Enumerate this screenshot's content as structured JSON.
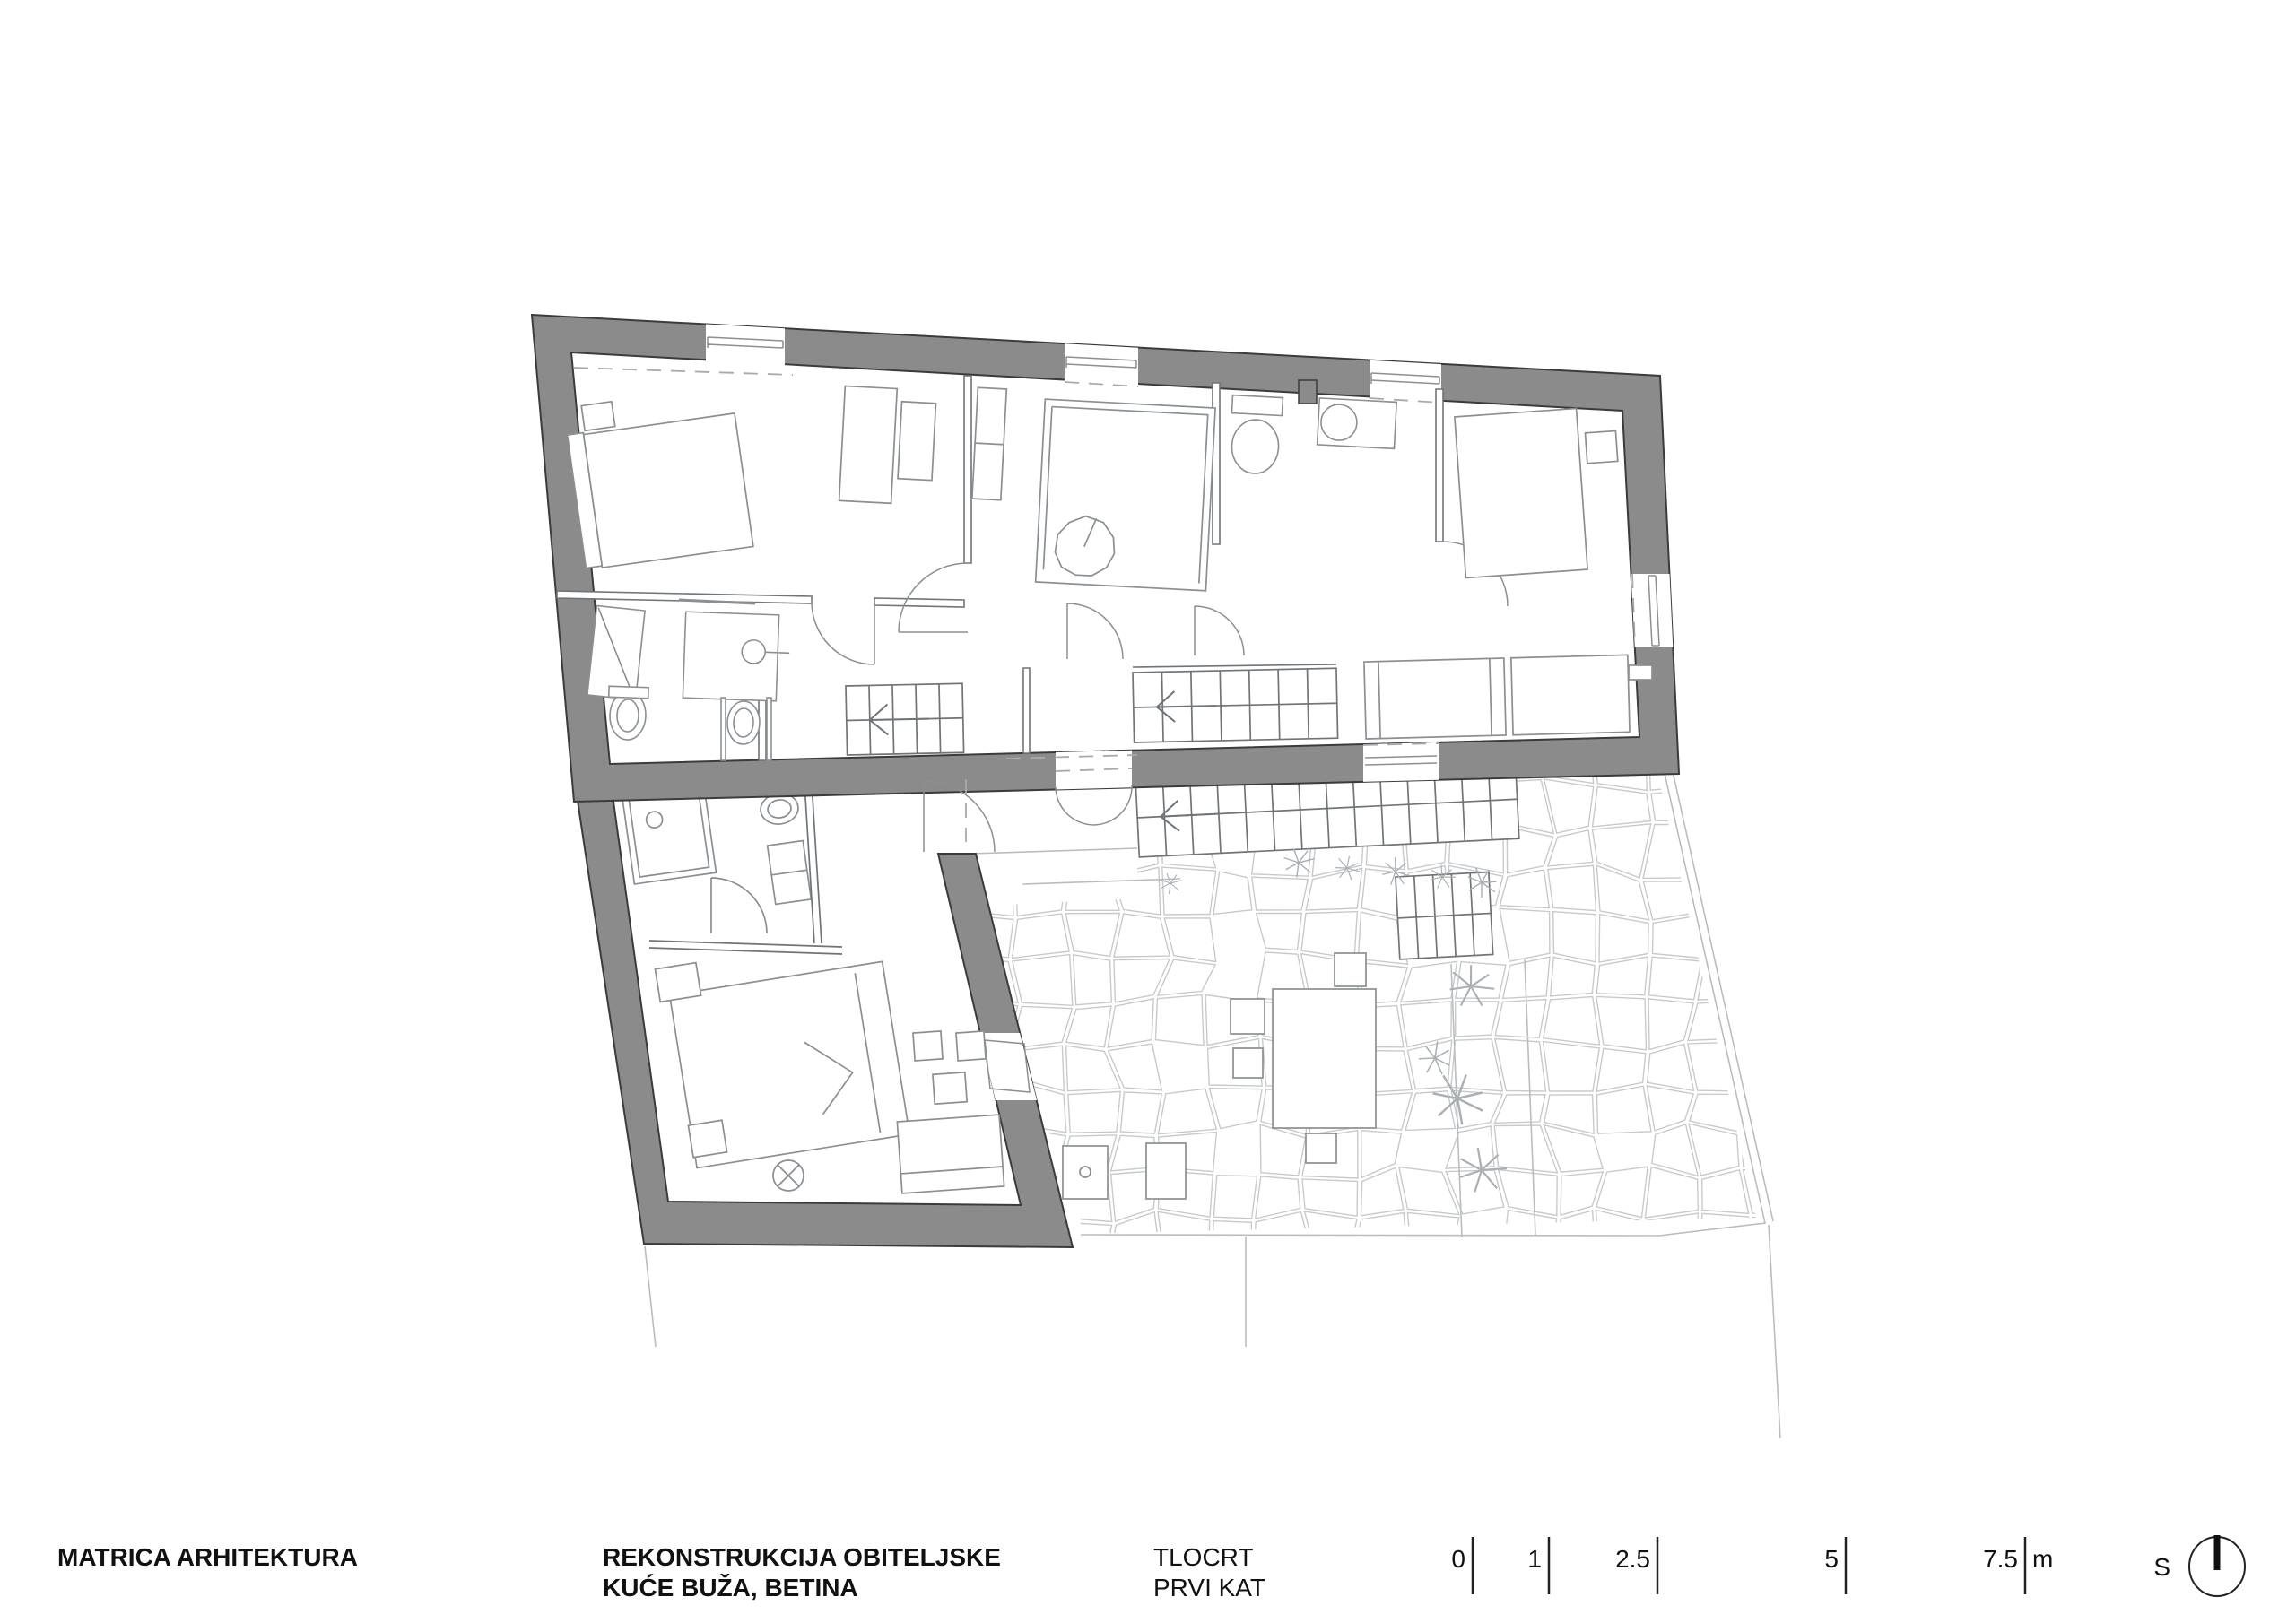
{
  "title_block": {
    "firm": "MATRICA ARHITEKTURA",
    "project_line1": "REKONSTRUKCIJA OBITELJSKE",
    "project_line2": "KUĆE BUŽA, BETINA",
    "drawing_line1": "TLOCRT",
    "drawing_line2": "PRVI KAT"
  },
  "scale_bar": {
    "ticks": [
      {
        "label": "0"
      },
      {
        "label": "1"
      },
      {
        "label": "2.5"
      },
      {
        "label": "5"
      },
      {
        "label": "7.5"
      }
    ],
    "unit": "m"
  },
  "north": {
    "label": "S"
  },
  "colors": {
    "background": "#ffffff",
    "wall_fill": "#8b8b8b",
    "wall_edge": "#3b3b3b",
    "partition_line": "#6f7478",
    "furniture_line": "#8a8f93",
    "paving_line": "#c7cacc",
    "dashed_line": "#a6aaad",
    "text_color": "#111111"
  }
}
